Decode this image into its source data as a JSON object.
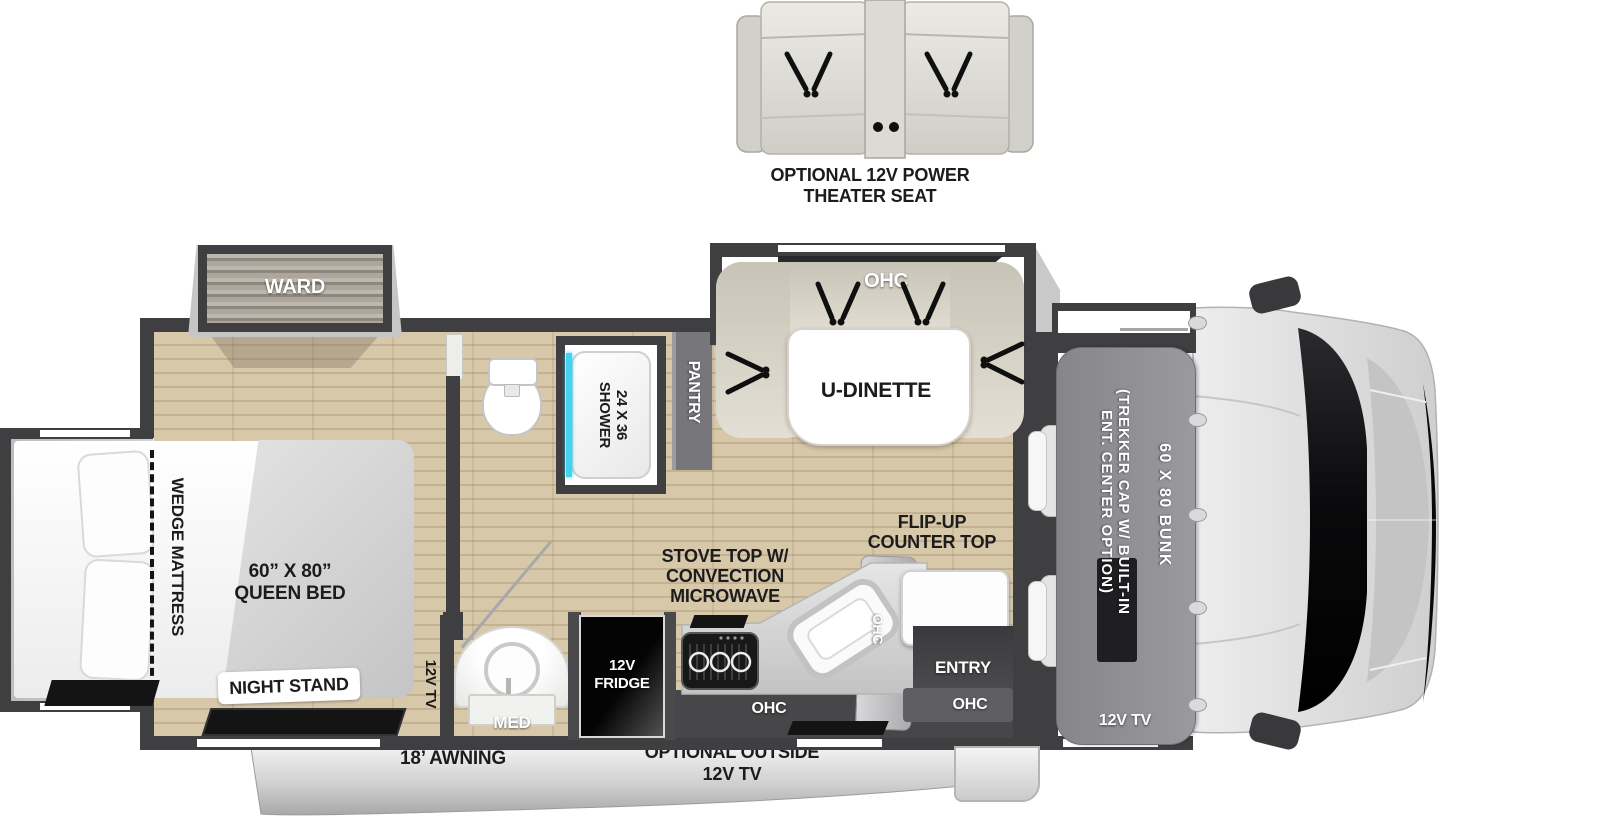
{
  "theater_seat": {
    "label": [
      "OPTIONAL 12V POWER",
      "THEATER SEAT"
    ]
  },
  "bedroom": {
    "ward": "WARD",
    "wedge": "WEDGE MATTRESS",
    "bed": [
      "60” X 80”",
      "QUEEN BED"
    ],
    "night_stand": "NIGHT STAND",
    "tv": "12V TV"
  },
  "bathroom": {
    "shower": [
      "24 X 36",
      "SHOWER"
    ],
    "med": "MED"
  },
  "kitchen": {
    "pantry": "PANTRY",
    "fridge": [
      "12V",
      "FRIDGE"
    ],
    "stove": [
      "STOVE TOP W/",
      "CONVECTION",
      "MICROWAVE"
    ],
    "flip_up": [
      "FLIP-UP",
      "COUNTER TOP"
    ],
    "ohc_lower": "OHC",
    "ohc_angled": "OHC"
  },
  "dinette": {
    "ohc": "OHC",
    "table": "U-DINETTE"
  },
  "entry": {
    "label": "ENTRY",
    "ohc": "OHC"
  },
  "front": {
    "trekker": [
      "(TREKKER CAP W/ BUILT-IN",
      "ENT. CENTER OPTION)"
    ],
    "bunk": "60 X 80 BUNK",
    "tv": "12V TV"
  },
  "exterior": {
    "awning": "18’ AWNING",
    "outside_tv": [
      "OPTIONAL OUTSIDE",
      "12V TV"
    ]
  },
  "colors": {
    "wall": "#3f3f41",
    "floor_wood": "#d7c8aa",
    "shower_glass": "#41d4f0",
    "bench": "#ddd9cd",
    "bunk_cap": "#909094",
    "fridge": "#0a0a0a",
    "awning_band": "#c9c9c9",
    "windshield": "#0d0d0f"
  }
}
